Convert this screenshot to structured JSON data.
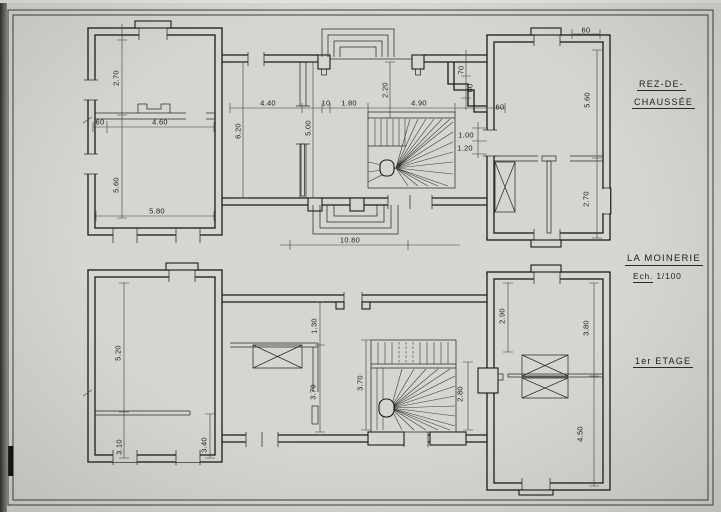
{
  "titles": {
    "floor1_line1": "REZ-DE-",
    "floor1_line2": "CHAUSSÉE",
    "project": "LA MOINERIE",
    "scale_label": "Ech.",
    "scale_value": "1/100",
    "floor2": "1er ETAGE"
  },
  "plans": [
    {
      "name": "rez-de-chaussee",
      "dims": [
        {
          "t": "2.70",
          "x": 116,
          "y": 78,
          "r": -90
        },
        {
          "t": "60",
          "x": 100,
          "y": 122,
          "r": 0
        },
        {
          "t": "4.60",
          "x": 160,
          "y": 122,
          "r": 0
        },
        {
          "t": "5.60",
          "x": 116,
          "y": 185,
          "r": -90
        },
        {
          "t": "5.80",
          "x": 157,
          "y": 211,
          "r": 0
        },
        {
          "t": "6.20",
          "x": 238,
          "y": 131,
          "r": -90
        },
        {
          "t": "4.40",
          "x": 268,
          "y": 103,
          "r": 0
        },
        {
          "t": "10",
          "x": 326,
          "y": 103,
          "r": 0
        },
        {
          "t": "1.80",
          "x": 349,
          "y": 103,
          "r": 0
        },
        {
          "t": "4.90",
          "x": 419,
          "y": 103,
          "r": 0
        },
        {
          "t": "5.00",
          "x": 308,
          "y": 128,
          "r": -90
        },
        {
          "t": "2.20",
          "x": 385,
          "y": 90,
          "r": -90
        },
        {
          "t": "70",
          "x": 461,
          "y": 70,
          "r": -90
        },
        {
          "t": "60",
          "x": 470,
          "y": 88,
          "r": -90
        },
        {
          "t": "60",
          "x": 500,
          "y": 107,
          "r": 0
        },
        {
          "t": "1.00",
          "x": 466,
          "y": 135,
          "r": 0
        },
        {
          "t": "1.20",
          "x": 465,
          "y": 148,
          "r": 0
        },
        {
          "t": "10.80",
          "x": 350,
          "y": 240,
          "r": 0
        },
        {
          "t": "60",
          "x": 586,
          "y": 30,
          "r": 0
        },
        {
          "t": "5.60",
          "x": 587,
          "y": 100,
          "r": -90
        },
        {
          "t": "2.70",
          "x": 586,
          "y": 199,
          "r": -90
        }
      ]
    },
    {
      "name": "premier-etage",
      "dims": [
        {
          "t": "5.20",
          "x": 118,
          "y": 353,
          "r": -90
        },
        {
          "t": "3.10",
          "x": 119,
          "y": 447,
          "r": -90
        },
        {
          "t": "3.40",
          "x": 204,
          "y": 445,
          "r": -90
        },
        {
          "t": "1.30",
          "x": 314,
          "y": 326,
          "r": -90
        },
        {
          "t": "3.70",
          "x": 313,
          "y": 392,
          "r": -90
        },
        {
          "t": "3.70",
          "x": 360,
          "y": 383,
          "r": -90
        },
        {
          "t": "2.80",
          "x": 460,
          "y": 394,
          "r": -90
        },
        {
          "t": "2.90",
          "x": 502,
          "y": 316,
          "r": -90
        },
        {
          "t": "3.80",
          "x": 586,
          "y": 328,
          "r": -90
        },
        {
          "t": "4.50",
          "x": 580,
          "y": 434,
          "r": -90
        }
      ]
    }
  ]
}
